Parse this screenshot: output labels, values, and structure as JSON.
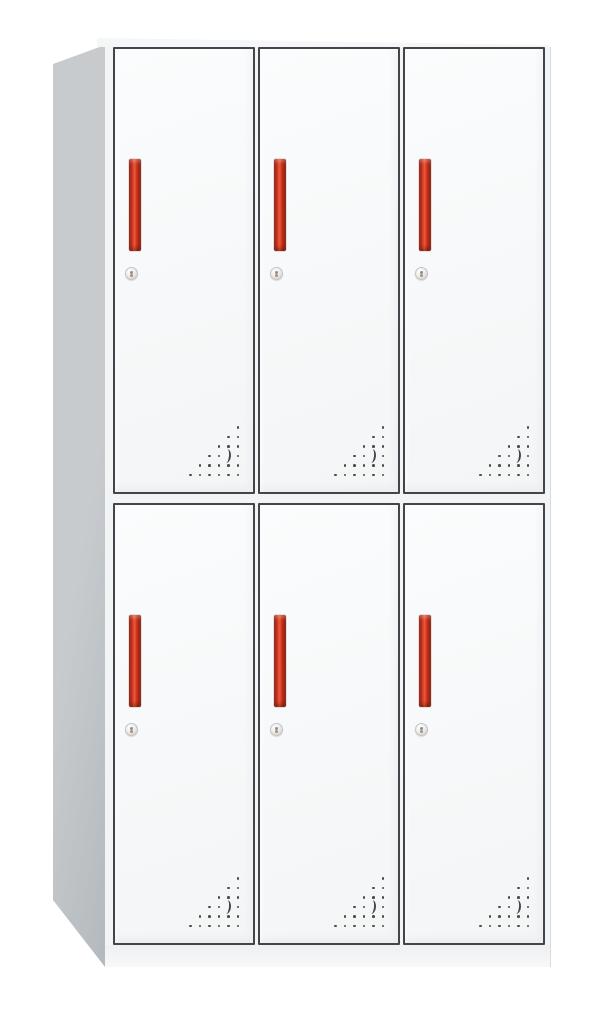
{
  "meta": {
    "description": "Product photograph of a six-door steel office locker cabinet shown in three-quarter view on a white background",
    "canvas": {
      "width": 605,
      "height": 1009
    }
  },
  "cabinet": {
    "door_rows": 2,
    "door_columns": 3,
    "door_count": 6,
    "features_per_door": [
      "recessed-red-handle",
      "round-cam-lock",
      "triangular-vent-holes"
    ],
    "vent": {
      "pattern": "right-triangle-dot-grid",
      "rows": 6,
      "spacing": 9.5,
      "dot_size": 2.6,
      "skip": [
        [
          3,
          4
        ]
      ],
      "has_crescent_slot": true
    }
  },
  "colors": {
    "background": "#ffffff",
    "side_panel": "#c7cbce",
    "side_panel_dark": "#b4b9bd",
    "top_surface": "#f4f6f7",
    "front_frame": "#f2f4f5",
    "door_face_light": "#fbfcfd",
    "door_face_shade": "#f3f5f6",
    "outline": "#42454a",
    "handle_bright": "#ee5a38",
    "handle_mid": "#d0341f",
    "handle_dark": "#8e1b10",
    "lock_light": "#ffffff",
    "lock_shade": "#c7cbce",
    "vent_dot": "#4a4c4e",
    "base": "#eef0f1",
    "edge_line": "#d9dcde"
  }
}
